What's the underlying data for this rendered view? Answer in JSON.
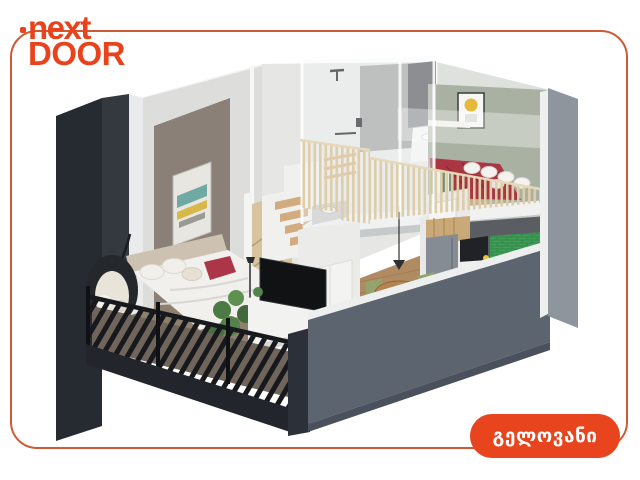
{
  "card": {
    "background": "#ffffff",
    "border_color": "#ce5a36"
  },
  "logo": {
    "line1": "next",
    "line2": "DOOR",
    "color": "#e8431c"
  },
  "badge": {
    "label": "გელოვანი",
    "background": "#e8441e",
    "text_color": "#ffffff"
  },
  "illustration": {
    "name": "isometric-loft-apartment-cutaway-render",
    "elements": [
      "mezzanine-bedroom",
      "red-double-bed",
      "wood-slat-railing",
      "upper-bathroom-shower",
      "staircase",
      "herringbone-stair-panel",
      "lower-bedroom-bed",
      "hanging-egg-chair",
      "tv-unit",
      "potted-plant",
      "dining-table-with-chairs",
      "kitchen-green-tile",
      "fridge",
      "balcony-black-railing",
      "framed-abstract-painting",
      "framed-sun-poster"
    ],
    "colors": {
      "exterior_dark": "#262a31",
      "exterior_dark2": "#343940",
      "exterior_slate": "#5c6470",
      "exterior_gray": "#8e959d",
      "roof_white": "#f2f3f2",
      "wall_white": "#e6e7e5",
      "wall_white2": "#dddedc",
      "wall_taupe": "#8b8077",
      "wall_sage": "#a9b1a3",
      "tile_gray": "#a2a3a1",
      "floor_wood": "#b08a60",
      "floor_gray": "#8f7f6e",
      "balcony_floor": "#70655a",
      "stair_wood": "#d2ab7e",
      "slat_wood": "#ddcda9",
      "chevron_wood": "#d8c49e",
      "bed_red": "#a93642",
      "pillow_red": "#ac3647",
      "linen_white": "#f1f0ec",
      "kitchen_tile": "#3f9e58",
      "railing_black": "#17191c",
      "plant_green": "#4c7a44"
    }
  }
}
